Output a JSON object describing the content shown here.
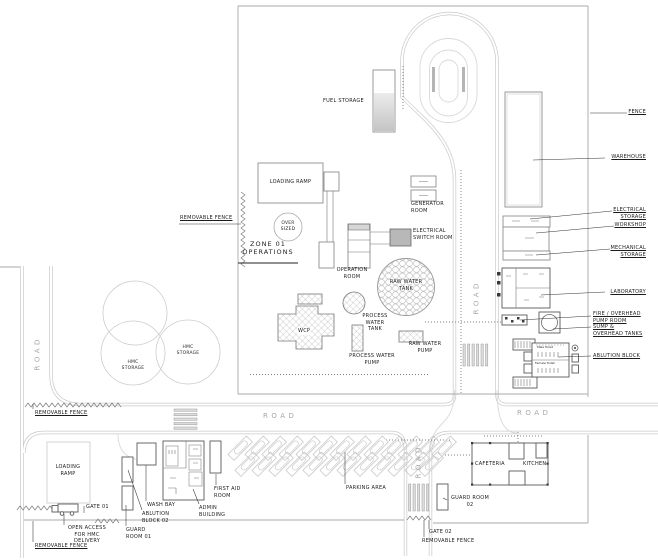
{
  "title": "Site layout plan",
  "colors": {
    "road_line": "#c9c9c9",
    "drawing_line": "#8f8f8f",
    "leader_line": "#333333",
    "building_fill_gray": "#b8b8b8",
    "text": "#1c1c1c"
  },
  "labels": {
    "road": "ROAD",
    "fence": "FENCE",
    "warehouse": "WAREHOUSE",
    "electrical_storage": "ELECTRICAL\nSTORAGE",
    "workshop": "WORKSHOP",
    "mechanical_storage": "MECHANICAL\nSTORAGE",
    "laboratory": "LABORATORY",
    "fire_overhead_pump_room": "FIRE / OVERHEAD\nPUMP ROOM",
    "sump_overhead_tanks": "SUMP &\nOVERHEAD TANKS",
    "ablution_block": "ABLUTION BLOCK",
    "fuel_storage": "FUEL STORAGE",
    "generator_room": "GENERATOR\nROOM",
    "electrical_switch_room": "ELECTRICAL\nSWITCH ROOM",
    "operation_room": "OPERATION\nROOM",
    "loading_ramp_zone01": "LOADING RAMP",
    "over_sized": "OVER\nSIZED",
    "zone_01_operations": "ZONE 01\nOPERATIONS",
    "removable_fence": "REMOVABLE FENCE",
    "raw_water_tank": "RAW WATER\nTANK",
    "process_water_tank": "PROCESS\nWATER\nTANK",
    "process_water_pump": "PROCESS WATER\nPUMP",
    "raw_water_pump": "RAW WATER\nPUMP",
    "wcp": "WCP",
    "hmc_storage": "HMC\nSTORAGE",
    "loading_ramp_south": "LOADING\nRAMP",
    "gate_01": "GATE 01",
    "open_access": "OPEN ACCESS\nFOR HMC\nDELIVERY",
    "guard_room_01": "GUARD\nROOM 01",
    "ablution_block_02": "ABLUTION\nBLOCK 02",
    "wash_bay": "WASH BAY",
    "admin_building": "ADMIN\nBUILDING",
    "first_aid_room": "FIRST AID\nROOM",
    "parking_area": "PARKING AREA",
    "gate_02": "GATE 02",
    "guard_room_02": "GUARD ROOM\n02",
    "cafeteria": "CAFETERIA",
    "kitchen": "KITCHEN",
    "male_toilet": "Male Toilet",
    "female_toilet": "Female Toilet"
  }
}
